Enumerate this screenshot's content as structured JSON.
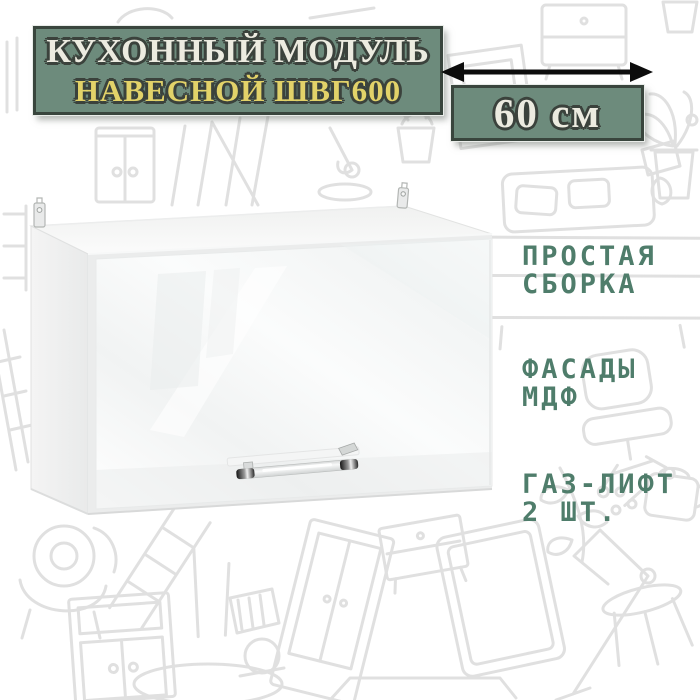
{
  "banner": {
    "title": "КУХОННЫЙ МОДУЛЬ",
    "subtitle": "НАВЕСНОЙ ШВГ600",
    "bg_color": "#6d8b7c",
    "border_color": "#39453d",
    "title_color": "#ecebe0",
    "subtitle_color": "#e2d269"
  },
  "dimension": {
    "label": "60 см",
    "arrow_icon": "double-headed-horizontal-arrow",
    "arrow_color": "#0c0c0c",
    "box_bg_color": "#6d8b7c",
    "label_color": "#ecebe0"
  },
  "features": {
    "text_color": "#4f7d6b",
    "items": [
      {
        "line1": "ПРОСТАЯ",
        "line2": "СБОРКА"
      },
      {
        "line1": "ФАСАДЫ",
        "line2": "МДФ"
      },
      {
        "line1": "ГАЗ-ЛИФТ",
        "line2": "2 ШТ."
      }
    ]
  },
  "cabinet": {
    "appearance": "white-glossy-wall-cabinet-with-horizontal-door-and-chrome-rail-handle"
  },
  "background": {
    "appearance": "light-gray-furniture-doodle-pattern",
    "doodle_color": "#d9d9d9"
  }
}
